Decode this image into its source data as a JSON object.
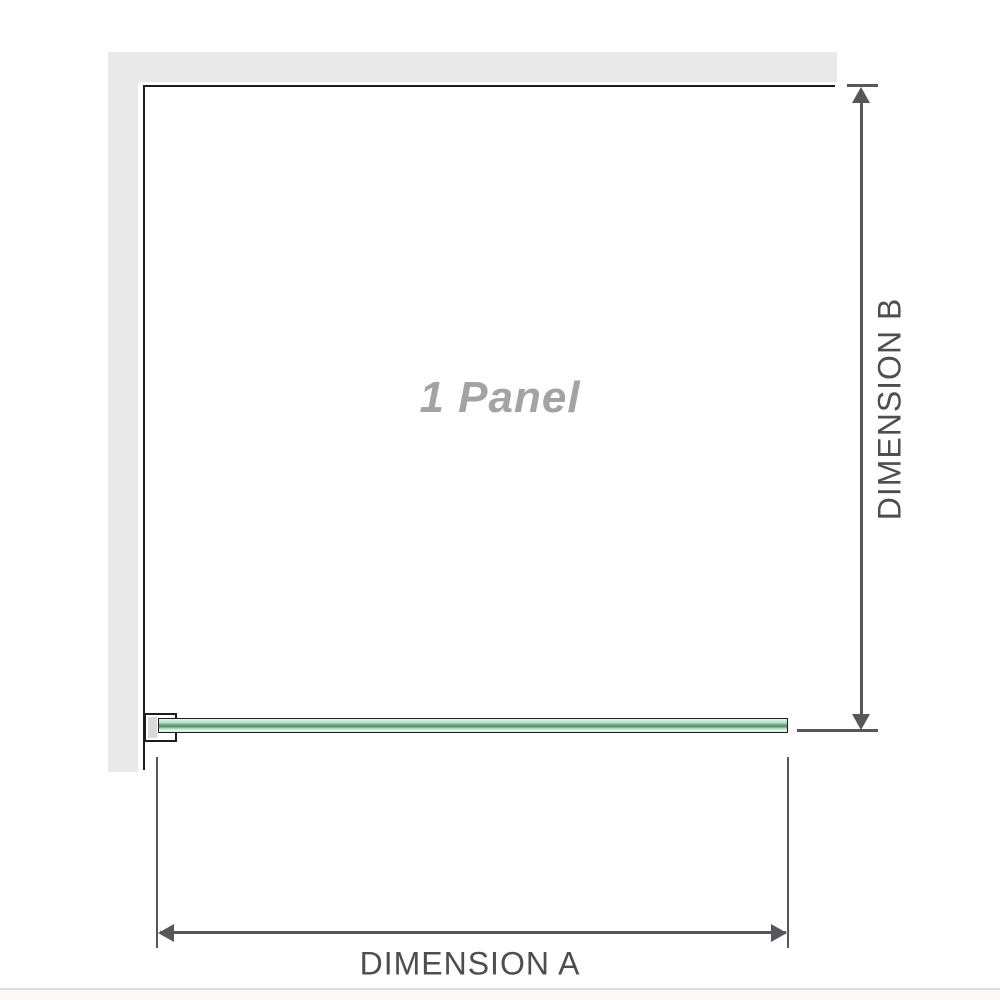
{
  "diagram": {
    "panel_label": "1 Panel",
    "dimensions": {
      "a_label": "DIMENSION A",
      "b_label": "DIMENSION B"
    }
  },
  "colors": {
    "wall": "#e9e9e9",
    "outline": "#1c1c1c",
    "dimension-line": "#55575a",
    "label-text": "#4c4e50",
    "panel-text": "#a3a3a3",
    "bracket-shade": "#d9d9d9",
    "glass-pale": "#e6f5ec",
    "glass-light": "#cdeeda",
    "glass-mid": "#aeddc1",
    "glass-dark": "#649579",
    "divider": "#dcdcd8",
    "footer-bg": "#fbfaf7"
  }
}
